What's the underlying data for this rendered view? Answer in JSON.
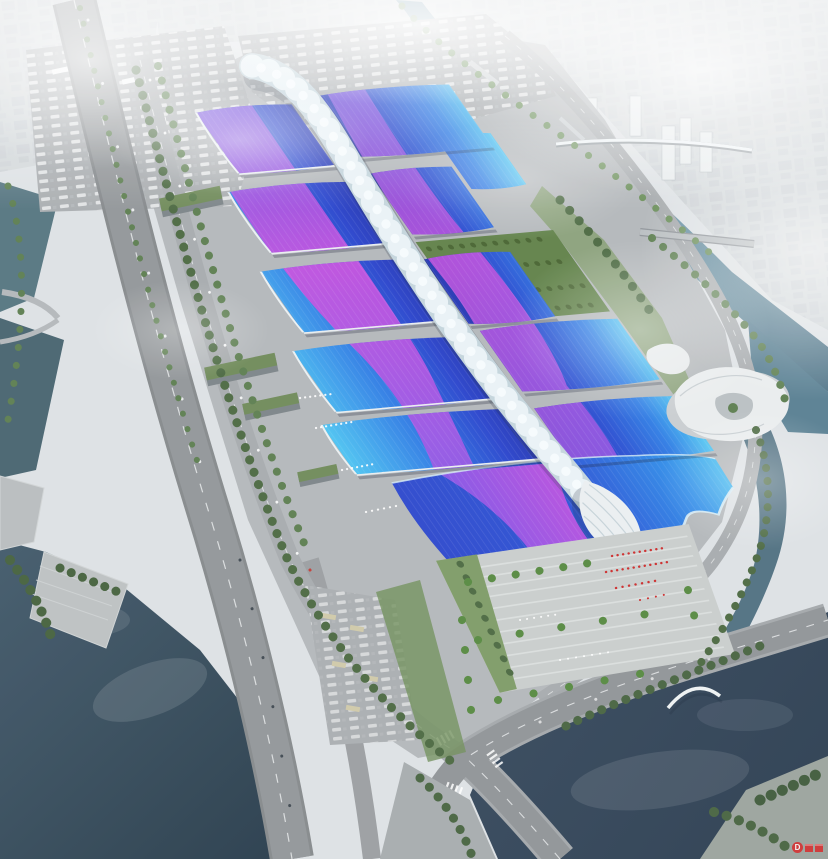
{
  "watermark": {
    "label": "D"
  },
  "palette": {
    "haze_bg": "#dde1e4",
    "city_base": "#d3d8da",
    "fog": "#ffffff",
    "water_canal": "#7ba3b4",
    "water_left": "#4e6f7b",
    "lake_left_dark": "#2b3f4e",
    "lake_right_dark": "#2e4051",
    "ground_site": "#b3b7ba",
    "ground_parking": "#a9adb0",
    "plaza": "#c9cdcc",
    "road": "#919598",
    "road_light": "#a6aaad",
    "roof_cyan": "#4cc4f2",
    "roof_blue": "#2e7ce4",
    "roof_deep": "#2742cc",
    "roof_navy": "#2336b4",
    "ribbon_magenta": "#c94fdf",
    "ribbon_violet": "#7a52e0",
    "spine_base": "#c3d4dc",
    "spine_bead": "#e9f2f6",
    "spine_hi": "#f6fbfd",
    "green_dark": "#4a6840",
    "green_mid": "#5b7d4e",
    "green_lawn": "#7d9a66",
    "shell_white": "#eaeff1",
    "red_accent": "#cc2b2b",
    "watermark_red": "#d63031"
  }
}
